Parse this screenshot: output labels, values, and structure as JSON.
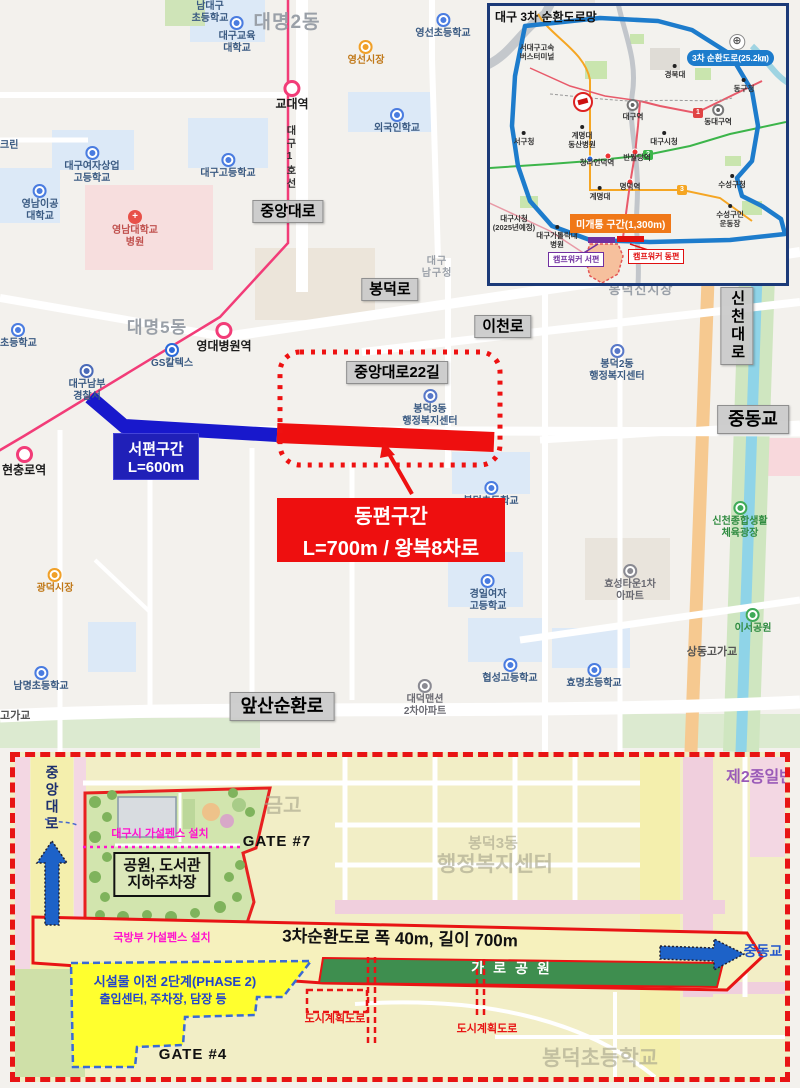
{
  "colors": {
    "subway_pink": "#f23c78",
    "west_blue": "#1818cc",
    "east_red": "#ee0f0f",
    "ring_blue": "#1d7ccc",
    "orange_road": "#f6c990",
    "river": "#8fd4e8",
    "plan_border_red": "#e81414",
    "phase2_yellow": "#ffff2e",
    "strip_green": "#3e8e4f",
    "fence_magenta": "#ff14cc"
  },
  "main_map": {
    "west_box": {
      "line1": "서편구간",
      "line2": "L=600m"
    },
    "east_box": {
      "line1": "동편구간",
      "line2": "L=700m / 왕복8차로"
    },
    "labels": [
      {
        "t": [
          "중앙대로"
        ],
        "x": 288,
        "y": 200,
        "cls": "rb",
        "nm": "road-label-jungang-daero"
      },
      {
        "t": [
          "봉덕로"
        ],
        "x": 390,
        "y": 278,
        "cls": "rb",
        "nm": "road-label-bongdeok-ro"
      },
      {
        "t": [
          "이천로"
        ],
        "x": 503,
        "y": 315,
        "cls": "rb",
        "nm": "road-label-icheon-ro"
      },
      {
        "t": [
          "중앙대로22길"
        ],
        "x": 397,
        "y": 361,
        "cls": "rb",
        "nm": "road-label-jungang-daero-22gil"
      },
      {
        "t": [
          "신천대로"
        ],
        "x": 737,
        "y": 287,
        "cls": "rb",
        "v": 1,
        "nm": "road-label-sincheon-daero"
      },
      {
        "t": [
          "중동교"
        ],
        "x": 753,
        "y": 405,
        "cls": "rb-lg",
        "nm": "road-label-jungdong-bridge"
      },
      {
        "t": [
          "앞산순환로"
        ],
        "x": 282,
        "y": 692,
        "cls": "rb-lg",
        "nm": "road-label-apsan-sunhwan-ro"
      },
      {
        "t": [
          "대명2동"
        ],
        "x": 287,
        "y": 12,
        "cls": "ar",
        "fs": 19,
        "nm": "area-label-daemyeong-2dong"
      },
      {
        "t": [
          "대명5동"
        ],
        "x": 157,
        "y": 318,
        "cls": "ar",
        "fs": 17,
        "nm": "area-label-daemyeong-5dong"
      },
      {
        "t": [
          "봉덕신시장"
        ],
        "x": 641,
        "y": 283,
        "cls": "ar",
        "fs": 13,
        "nm": "area-label-bongdeok-sinsijang"
      },
      {
        "t": [
          "대구",
          "남구청"
        ],
        "x": 437,
        "y": 256,
        "cls": "ar",
        "fs": 10,
        "nm": "area-label-namgu-office"
      },
      {
        "t": [
          "남대구",
          "초등학교"
        ],
        "x": 210,
        "y": 1,
        "cls": "c-blue",
        "nm": "poi-namdaegu-elementary"
      },
      {
        "t": [
          "대구교육",
          "대학교"
        ],
        "x": 237,
        "y": 16,
        "cls": "c-blue",
        "ic": "school",
        "nm": "poi-daegu-natl-univ-education"
      },
      {
        "t": [
          "영선초등학교"
        ],
        "x": 443,
        "y": 13,
        "cls": "c-blue",
        "ic": "school",
        "nm": "poi-yeongseon-elementary"
      },
      {
        "t": [
          "영선시장"
        ],
        "x": 366,
        "y": 40,
        "cls": "c-orange",
        "ic": "market",
        "nm": "poi-yeongseon-market"
      },
      {
        "t": [
          "교대역"
        ],
        "x": 292,
        "y": 80,
        "cls": "st",
        "ic": "station",
        "nm": "station-gyodae"
      },
      {
        "t": [
          "외국인학교"
        ],
        "x": 397,
        "y": 108,
        "cls": "c-blue",
        "ic": "school",
        "nm": "poi-foreign-school"
      },
      {
        "t": [
          "대구고등학교"
        ],
        "x": 228,
        "y": 153,
        "cls": "c-blue",
        "ic": "school",
        "nm": "poi-daegu-high"
      },
      {
        "t": [
          "대구여자상업",
          "고등학교"
        ],
        "x": 92,
        "y": 146,
        "cls": "c-blue",
        "ic": "school",
        "nm": "poi-daegu-girls-commercial-high"
      },
      {
        "t": [
          "영남이공",
          "대학교"
        ],
        "x": 40,
        "y": 184,
        "cls": "c-blue",
        "ic": "school",
        "nm": "poi-yeungnam-univ-tech"
      },
      {
        "t": [
          "영남대학교",
          "병원"
        ],
        "x": 135,
        "y": 210,
        "cls": "c-red",
        "ic": "hosp",
        "nm": "poi-yeungnam-univ-hospital"
      },
      {
        "t": [
          "크린"
        ],
        "x": 0,
        "y": 140,
        "cls": "c-blue",
        "al": 1,
        "nm": "poi-clipped-left-1"
      },
      {
        "t": [
          "GS칼텍스"
        ],
        "x": 172,
        "y": 343,
        "cls": "c-blue",
        "ic": "gs",
        "nm": "poi-gs-caltex"
      },
      {
        "t": [
          "영대병원역"
        ],
        "x": 224,
        "y": 322,
        "cls": "st",
        "ic": "station",
        "nm": "station-yeungdae-hospital"
      },
      {
        "t": [
          "대구남부",
          "경찰서"
        ],
        "x": 87,
        "y": 364,
        "cls": "c-blue",
        "ic": "police",
        "nm": "poi-daegu-nambu-police"
      },
      {
        "t": [
          "초등학교"
        ],
        "x": 0,
        "y": 323,
        "cls": "c-blue",
        "al": 1,
        "ic": "school",
        "nm": "poi-clipped-elementary"
      },
      {
        "t": [
          "현충로역"
        ],
        "x": 2,
        "y": 446,
        "cls": "st",
        "al": 1,
        "ic": "station",
        "nm": "station-hyeonchungno"
      },
      {
        "t": [
          "봉덕2동",
          "행정복지센터"
        ],
        "x": 617,
        "y": 344,
        "cls": "c-blue",
        "ic": "gov",
        "nm": "poi-bongdeok2-center"
      },
      {
        "t": [
          "봉덕3동",
          "행정복지센터"
        ],
        "x": 430,
        "y": 389,
        "cls": "c-blue",
        "ic": "gov",
        "nm": "poi-bongdeok3-center"
      },
      {
        "t": [
          "봉덕초등학교"
        ],
        "x": 491,
        "y": 481,
        "cls": "c-blue",
        "ic": "school",
        "nm": "poi-bongdeok-elementary"
      },
      {
        "t": [
          "광덕시장"
        ],
        "x": 55,
        "y": 568,
        "cls": "c-orange",
        "ic": "market",
        "nm": "poi-gwangdeok-market"
      },
      {
        "t": [
          "효성타운1차",
          "아파트"
        ],
        "x": 630,
        "y": 564,
        "cls": "c-gray",
        "ic": "apt",
        "nm": "poi-hyosung-town-apt"
      },
      {
        "t": [
          "경일여자",
          "고등학교"
        ],
        "x": 488,
        "y": 574,
        "cls": "c-blue",
        "ic": "school",
        "nm": "poi-kyungil-girls-high"
      },
      {
        "t": [
          "협성고등학교"
        ],
        "x": 510,
        "y": 658,
        "cls": "c-blue",
        "ic": "school",
        "nm": "poi-hyeopseong-high"
      },
      {
        "t": [
          "효명초등학교"
        ],
        "x": 594,
        "y": 663,
        "cls": "c-blue",
        "ic": "school",
        "nm": "poi-hyomyeong-elementary"
      },
      {
        "t": [
          "대덕맨션",
          "2차아파트"
        ],
        "x": 425,
        "y": 679,
        "cls": "c-gray",
        "ic": "apt",
        "nm": "poi-daedeok-mansion-apt"
      },
      {
        "t": [
          "남명초등학교"
        ],
        "x": 41,
        "y": 666,
        "cls": "c-blue",
        "ic": "school",
        "nm": "poi-nammyeong-elementary"
      },
      {
        "t": [
          "이서공원"
        ],
        "x": 753,
        "y": 608,
        "cls": "c-green",
        "ic": "park",
        "nm": "poi-iseo-park"
      },
      {
        "t": [
          "신천종합생활",
          "체육광장"
        ],
        "x": 740,
        "y": 501,
        "cls": "c-green",
        "ic": "park",
        "nm": "poi-sincheon-sports-plaza"
      },
      {
        "t": [
          "상동고가교"
        ],
        "x": 712,
        "y": 646,
        "cls": "br",
        "nm": "bridge-label-sangdong"
      },
      {
        "t": [
          "고가교"
        ],
        "x": 0,
        "y": 710,
        "cls": "br",
        "al": 1,
        "nm": "bridge-label-clipped"
      },
      {
        "t": [
          "대구1호선"
        ],
        "x": 289,
        "y": 125,
        "cls": "tiny",
        "v": 1,
        "fs": 10,
        "nm": "subway-line1-label"
      }
    ]
  },
  "inset": {
    "title": "대구 3차 순환도로망",
    "ring_badge": "3차 순환도로(25.2㎞)",
    "open_section": "미개통 구간(1,300m)",
    "camp_west": "캠프워커 서편",
    "camp_east": "캠프워커 동편",
    "line_badges": [
      "1",
      "2",
      "3"
    ],
    "labels": [
      {
        "t": [
          "대구국제공항"
        ],
        "x": 247,
        "y": 28,
        "cls": "tiny",
        "ic": "air",
        "nm": "inset-daegu-airport"
      },
      {
        "t": [
          "서대구고속",
          "버스터미널"
        ],
        "x": 47,
        "y": 37,
        "cls": "tiny",
        "nm": "inset-seodaegu-terminal"
      },
      {
        "t": [
          "경북대"
        ],
        "x": 185,
        "y": 58,
        "cls": "tiny",
        "ic": "dotb",
        "nm": "inset-kyungpook-univ"
      },
      {
        "t": [
          "동구청"
        ],
        "x": 254,
        "y": 72,
        "cls": "tiny",
        "ic": "dotb",
        "nm": "inset-donggu-office"
      },
      {
        "t": [
          "동대구역"
        ],
        "x": 228,
        "y": 98,
        "cls": "tiny",
        "ic": "sta2",
        "nm": "inset-dongdaegu-station"
      },
      {
        "t": [
          "대구역"
        ],
        "x": 143,
        "y": 93,
        "cls": "tiny",
        "ic": "sta2",
        "nm": "inset-daegu-station"
      },
      {
        "t": [
          "서구청"
        ],
        "x": 34,
        "y": 125,
        "cls": "tiny",
        "ic": "dotb",
        "nm": "inset-seogu-office"
      },
      {
        "t": [
          "계명대",
          "동산병원"
        ],
        "x": 92,
        "y": 119,
        "cls": "tiny",
        "ic": "dotb",
        "nm": "inset-dongsan-hospital"
      },
      {
        "t": [
          "대구시청"
        ],
        "x": 174,
        "y": 125,
        "cls": "tiny",
        "ic": "dotb",
        "nm": "inset-daegu-cityhall"
      },
      {
        "t": [
          "청라언덕역"
        ],
        "x": 107,
        "y": 152,
        "cls": "tiny",
        "nm": "inset-cheongna-station"
      },
      {
        "t": [
          "반월당역"
        ],
        "x": 147,
        "y": 147,
        "cls": "tiny",
        "nm": "inset-banwoldang-station"
      },
      {
        "t": [
          "수성구청"
        ],
        "x": 242,
        "y": 168,
        "cls": "tiny",
        "ic": "dotb",
        "nm": "inset-suseonggu-office"
      },
      {
        "t": [
          "계명대"
        ],
        "x": 110,
        "y": 180,
        "cls": "tiny",
        "ic": "dotb",
        "nm": "inset-keimyung-univ"
      },
      {
        "t": [
          "명덕역"
        ],
        "x": 140,
        "y": 176,
        "cls": "tiny",
        "nm": "inset-myeongdeok-station"
      },
      {
        "t": [
          "수성구민",
          "운동장"
        ],
        "x": 240,
        "y": 198,
        "cls": "tiny",
        "ic": "dotb",
        "nm": "inset-suseong-stadium"
      },
      {
        "t": [
          "대구시청",
          "(2025년예정)"
        ],
        "x": 24,
        "y": 208,
        "cls": "tiny",
        "nm": "inset-cityhall-2025"
      },
      {
        "t": [
          "대구가톨릭대",
          "병원"
        ],
        "x": 67,
        "y": 219,
        "cls": "tiny",
        "ic": "dotb",
        "nm": "inset-catholic-hospital"
      }
    ]
  },
  "bottom": {
    "labels": [
      {
        "t": [
          "금고"
        ],
        "x": 268,
        "y": 38,
        "cls": "fade",
        "fs": 20,
        "nm": "faded-map-text-1"
      },
      {
        "t": [
          "봉덕3동"
        ],
        "x": 478,
        "y": 78,
        "cls": "fade",
        "fs": 15,
        "nm": "faded-bongdeok3"
      },
      {
        "t": [
          "행정복지센터"
        ],
        "x": 480,
        "y": 96,
        "cls": "fade",
        "fs": 21,
        "nm": "faded-community-center"
      },
      {
        "t": [
          "봉덕초등학교"
        ],
        "x": 585,
        "y": 290,
        "cls": "fade",
        "fs": 21,
        "nm": "faded-bongdeok-elementary"
      },
      {
        "t": [
          "제2종일반"
        ],
        "x": 745,
        "y": 12,
        "cls": "purple",
        "fs": 16,
        "nm": "zoning-label"
      },
      {
        "t": [
          "GATE #7"
        ],
        "x": 262,
        "y": 76,
        "cls": "gate",
        "nm": "gate-7-label"
      },
      {
        "t": [
          "GATE #4"
        ],
        "x": 178,
        "y": 289,
        "cls": "gate",
        "nm": "gate-4-label"
      },
      {
        "t": [
          "대구시 가설펜스 설치"
        ],
        "x": 145,
        "y": 71,
        "cls": "mag",
        "nm": "daegu-city-fence-label"
      },
      {
        "t": [
          "국방부 가설펜스 설치"
        ],
        "x": 147,
        "y": 175,
        "cls": "mag",
        "nm": "defense-ministry-fence-label"
      },
      {
        "t": [
          "도시계획도로"
        ],
        "x": 320,
        "y": 256,
        "cls": "redt",
        "nm": "urban-planning-road-label-1"
      },
      {
        "t": [
          "도시계획도로"
        ],
        "x": 472,
        "y": 266,
        "cls": "redt",
        "nm": "urban-planning-road-label-2"
      },
      {
        "t": [
          "3차순환도로  폭 40m, 길이 700m"
        ],
        "x": 385,
        "y": 172,
        "cls": "blackbig",
        "nm": "ring-road-spec-label"
      },
      {
        "t": [
          "가로공원"
        ],
        "x": 500,
        "y": 203,
        "cls": "gpark",
        "nm": "linear-park-label"
      },
      {
        "t": [
          "중동교"
        ],
        "x": 748,
        "y": 186,
        "cls": "bluet",
        "nm": "jungdong-bridge-label"
      },
      {
        "t": [
          "중앙대로"
        ],
        "x": 37,
        "y": 8,
        "cls": "navyv",
        "v": 1,
        "nm": "jungang-daero-vertical-label"
      },
      {
        "t": [
          "공원, 도서관",
          "지하주차장"
        ],
        "x": 147,
        "y": 95,
        "cls": "pbox",
        "nm": "park-library-parking-box"
      },
      {
        "t": [
          "시설물 이전 2단계(PHASE 2)"
        ],
        "x": 160,
        "y": 218,
        "cls": "redt",
        "fs": 13,
        "nm": "phase2-title"
      },
      {
        "t": [
          "출입센터, 주차장, 담장 등"
        ],
        "x": 148,
        "y": 236,
        "cls": "redt",
        "fs": 12,
        "nm": "phase2-subtitle"
      }
    ],
    "phase2_text_color": "#2244cc"
  }
}
